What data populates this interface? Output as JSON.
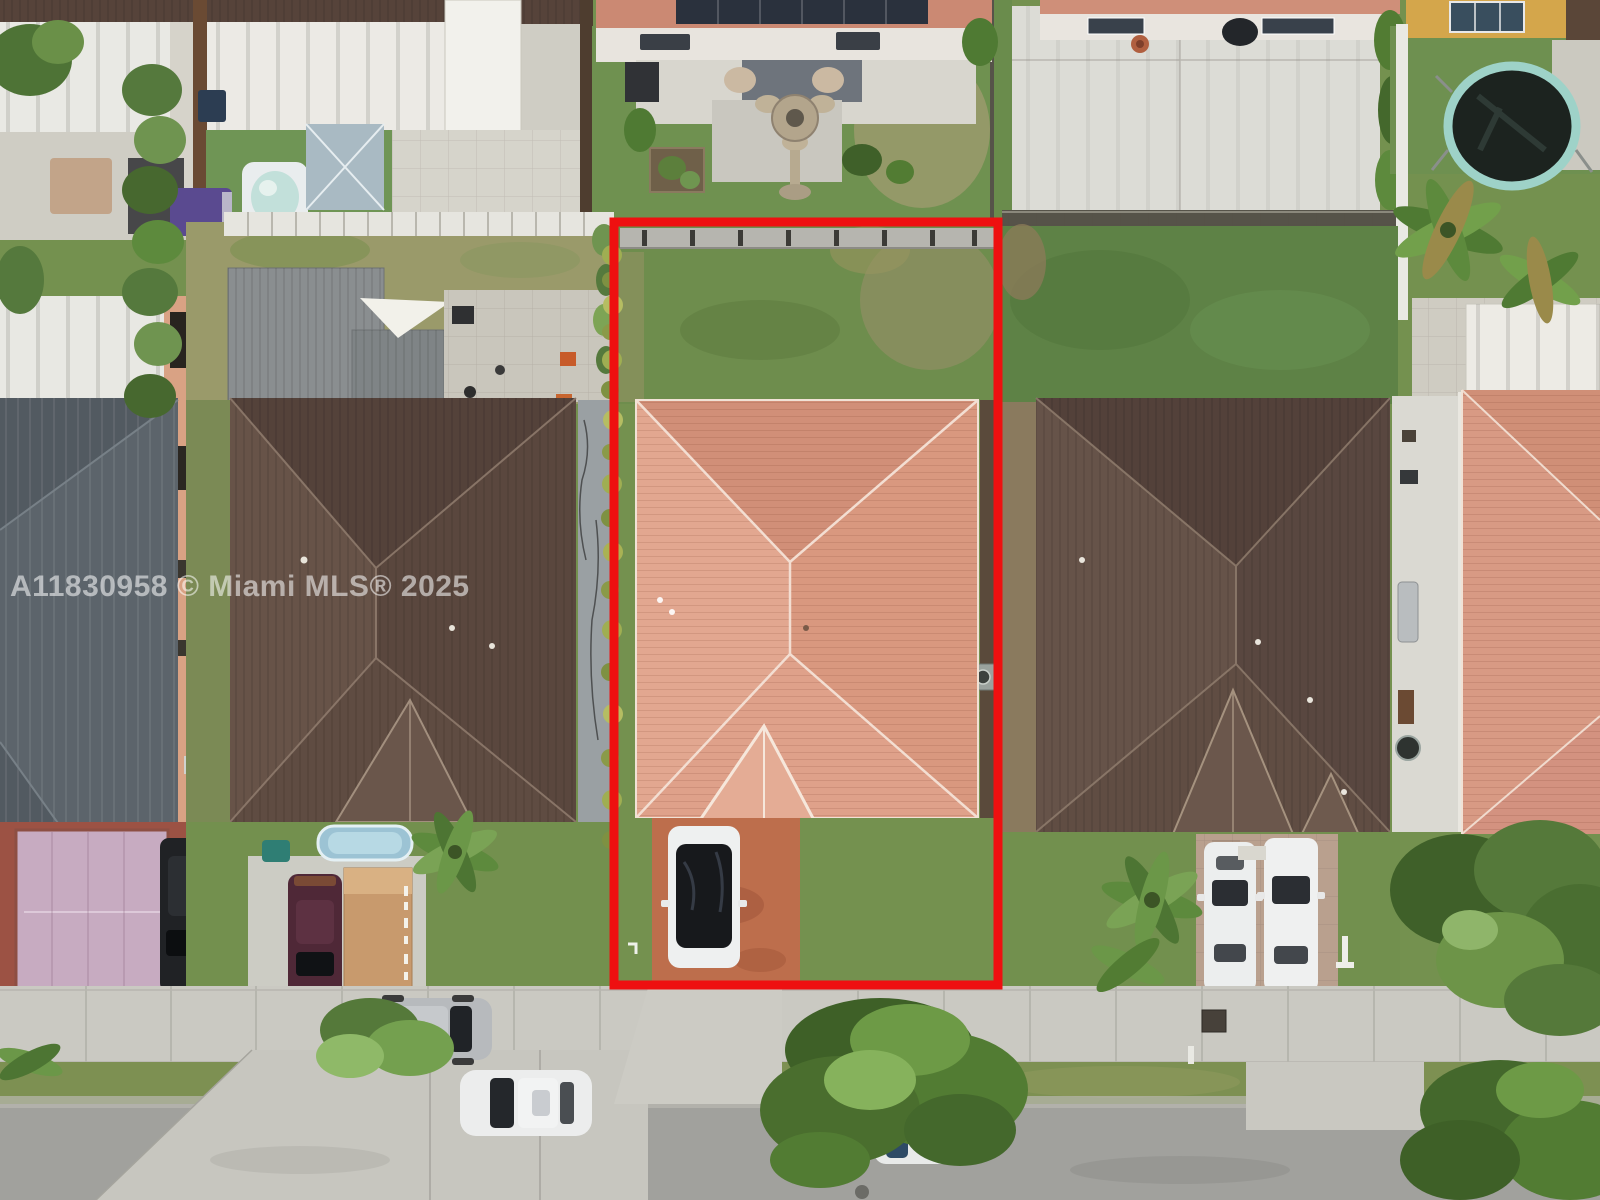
{
  "watermark": {
    "text": "A11830958 © Miami MLS® 2025"
  },
  "scene": {
    "type": "aerial-drone-photo",
    "subject": "center residential lot outlined in red",
    "outline_shape": "rectangle"
  },
  "colors": {
    "boundary_red": "#ee1010",
    "grass_green": "#74914f",
    "backyard_grass": "#6e8d4d",
    "subject_roof_salmon": "#db9d87",
    "neighbor_roof_brown": "#5e4b41",
    "right_roof_brown": "#5d4a41",
    "far_right_roof_salmon": "#d89a84",
    "metal_roof_gray": "#5c646b",
    "sidewalk_concrete": "#cac9c2",
    "street_asphalt": "#a1a19d",
    "driveway_clay": "#bd6e4c",
    "paver_driveway_tan": "#b9a08e",
    "concrete_slab": "#dcdcd6"
  }
}
